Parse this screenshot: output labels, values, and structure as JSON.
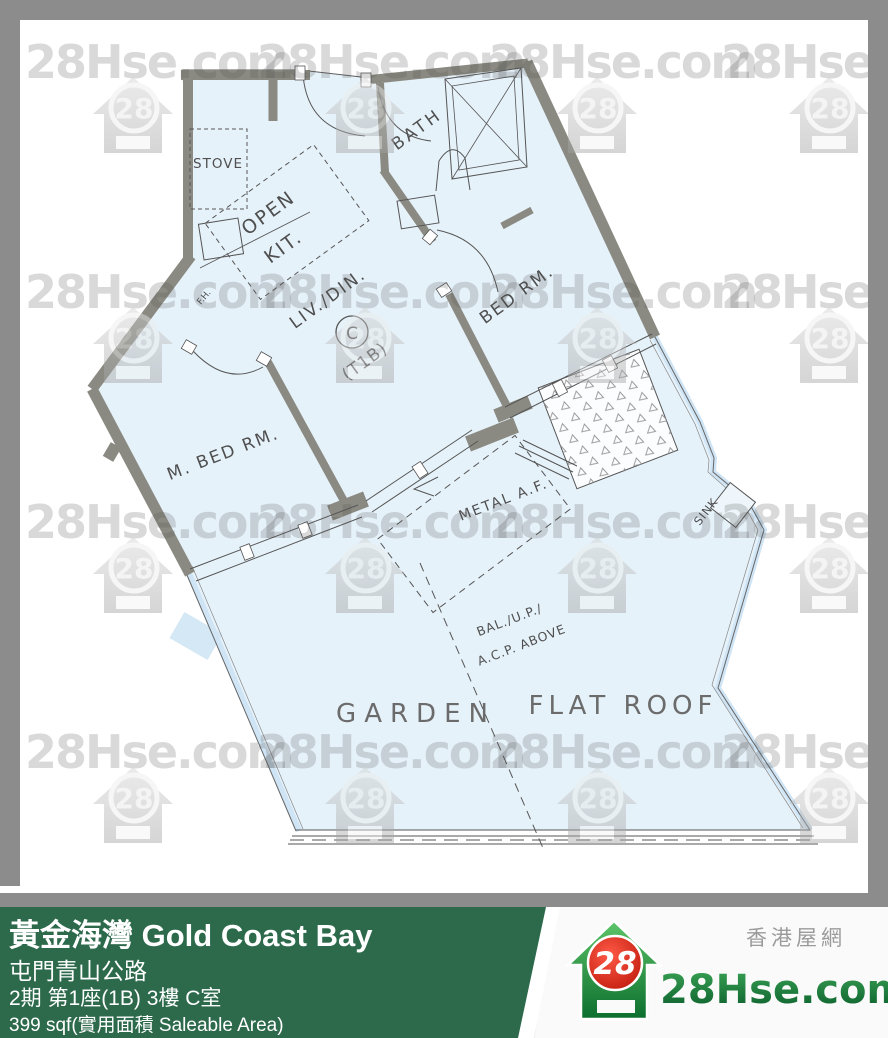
{
  "watermark": {
    "text": "28Hse.com",
    "badge": "28"
  },
  "plan": {
    "rooms": {
      "stove": "STOVE",
      "open_kit_1": "OPEN",
      "open_kit_2": "KIT.",
      "bath": "BATH",
      "living": "LIV./DIN.",
      "unit_type": "(T1B)",
      "unit_letter": "C",
      "bedroom": "BED RM.",
      "master_bedroom": "M. BED RM.",
      "fire_hose": "F.H.",
      "metal_af": "METAL A.F.",
      "sink": "SINK",
      "balcony_1": "BAL./U.P./",
      "balcony_2": "A.C.P. ABOVE",
      "garden": "GARDEN",
      "flat_roof": "FLAT ROOF"
    }
  },
  "banner": {
    "title": "黃金海灣 Gold Coast Bay",
    "address": "屯門青山公路",
    "unit": "2期 第1座(1B) 3樓 C室",
    "area": "399 sqf(實用面積 Saleable Area)"
  },
  "logo": {
    "site_cn": "香港屋網",
    "site_name": "28Hse.com",
    "badge": "28"
  },
  "colors": {
    "frame_gray": "#8c8c8c",
    "banner_green": "#2d6a4c",
    "floor_blue": "#e6f2fa",
    "wall_gray": "#8a8a82",
    "logo_red": "#d92c18",
    "logo_green": "#1e8c46"
  }
}
